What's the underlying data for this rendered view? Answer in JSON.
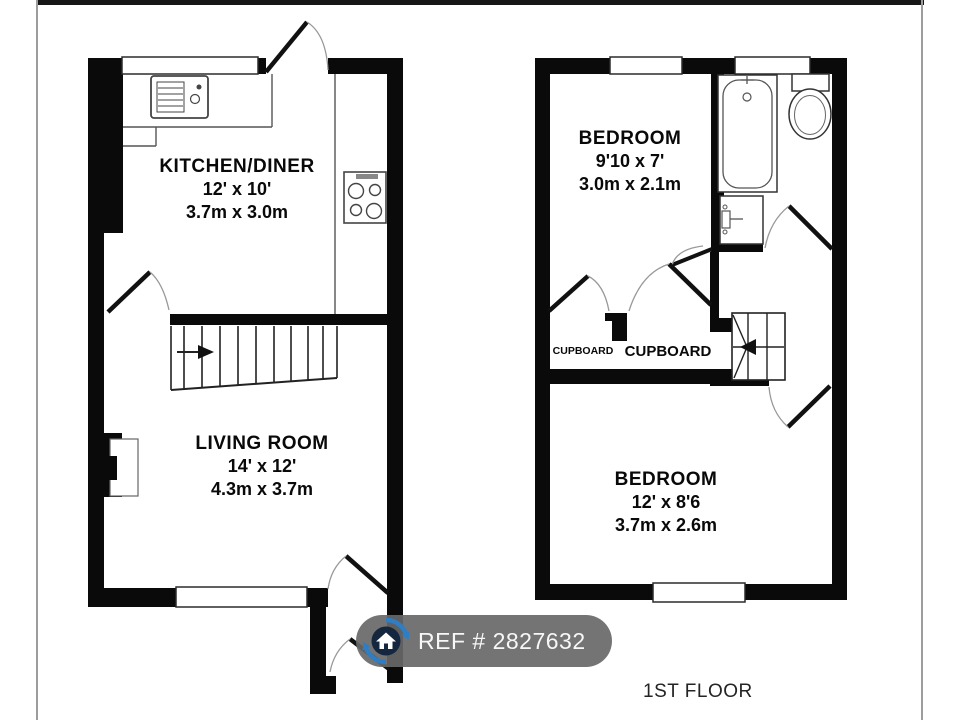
{
  "ground_floor": {
    "kitchen": {
      "name": "KITCHEN/DINER",
      "imperial": "12' x 10'",
      "metric": "3.7m x 3.0m"
    },
    "living": {
      "name": "LIVING ROOM",
      "imperial": "14' x 12'",
      "metric": "4.3m x 3.7m"
    }
  },
  "first_floor": {
    "bedroom1": {
      "name": "BEDROOM",
      "imperial": "9'10 x 7'",
      "metric": "3.0m x 2.1m"
    },
    "bedroom2": {
      "name": "BEDROOM",
      "imperial": "12' x 8'6",
      "metric": "3.7m x 2.6m"
    },
    "cupboard1": "CUPBOARD",
    "cupboard2": "CUPBOARD",
    "label": "1ST FLOOR"
  },
  "badge": {
    "text": "REF # 2827632",
    "icon": "home-icon"
  },
  "colors": {
    "wall": "#0a0a0a",
    "logo_blue": "#2f7dc2",
    "logo_navy": "#15263f",
    "badge_bg": "#686868"
  }
}
